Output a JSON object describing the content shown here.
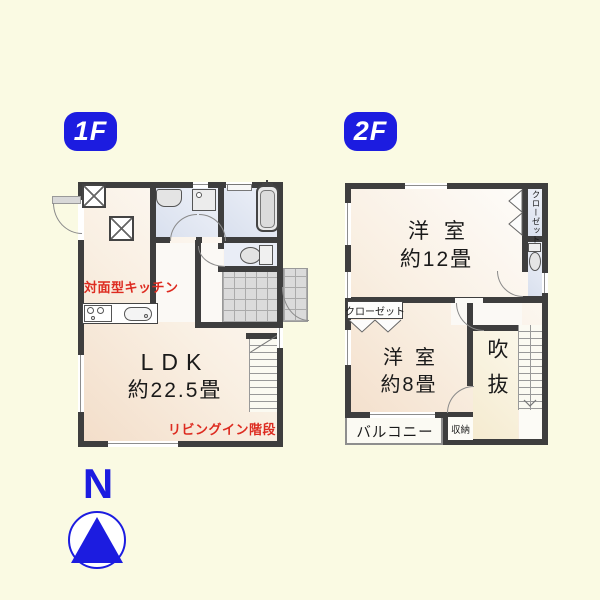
{
  "badges": {
    "floor1": "1F",
    "floor2": "2F"
  },
  "floor1": {
    "kitchen_label": "対面型キッチン",
    "ldk_label": "LDK",
    "ldk_size": "約22.5畳",
    "stairs_label": "リビングイン階段"
  },
  "floor2": {
    "room1_label": "洋室",
    "room1_size": "約12畳",
    "closet_right_label": "クローゼット",
    "closet_left_label": "クローゼット",
    "room2_label": "洋室",
    "room2_size": "約8畳",
    "void_label": "吹抜",
    "balcony_label": "バルコニー",
    "storage_label": "収納"
  },
  "compass": {
    "north_label": "N"
  },
  "colors": {
    "accent_blue": "#1c1ce0",
    "wall": "#3e3e3e",
    "red_text": "#dd2b20",
    "wet_blue": "#dfe4f0",
    "room_peach": "#f4dfca",
    "background": "#fafae3"
  }
}
